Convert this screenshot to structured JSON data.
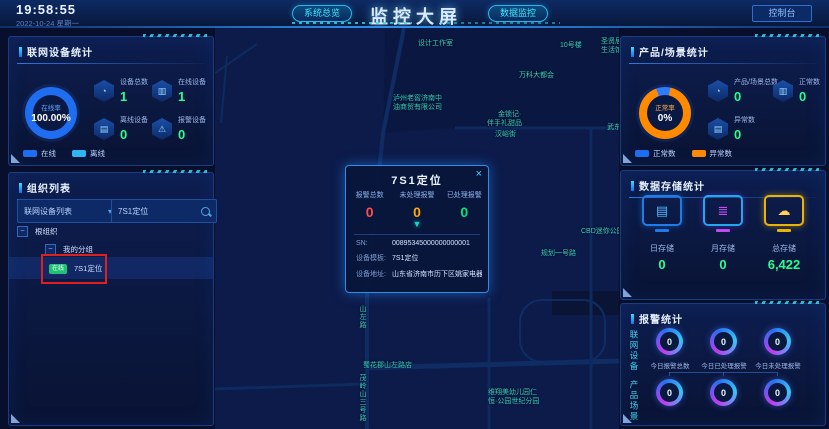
{
  "header": {
    "time": "19:58:55",
    "date": "2022-10-24 星期一",
    "tab_overview": "系统总览",
    "title": "监控大屏",
    "tab_data": "数据监控",
    "console": "控制台",
    "accent_color": "#3fe6ff"
  },
  "device_panel": {
    "title": "联网设备统计",
    "donut": {
      "label": "在线率",
      "value": "100.00%",
      "ring_color": "#1f6df0"
    },
    "stats": [
      {
        "label": "设备总数",
        "value": "1",
        "icon": "pie-icon"
      },
      {
        "label": "在线设备",
        "value": "1",
        "icon": "monitor-icon"
      },
      {
        "label": "离线设备",
        "value": "0",
        "icon": "offline-icon"
      },
      {
        "label": "报警设备",
        "value": "0",
        "icon": "alarm-icon"
      }
    ],
    "legend": [
      {
        "label": "在线",
        "color": "#1f6df0"
      },
      {
        "label": "离线",
        "color": "#2fb6f2"
      }
    ],
    "value_color": "#2aff8e"
  },
  "org_panel": {
    "title": "组织列表",
    "dropdown_value": "联网设备列表",
    "search_value": "7S1定位",
    "tree_root": "根组织",
    "tree_group": "我的分组",
    "tree_item": {
      "badge": "在线",
      "badge_color": "#21c176",
      "label": "7S1定位",
      "selected": true
    },
    "annotation_color": "#e02020"
  },
  "map": {
    "labels": [
      {
        "text": "设计工作室"
      },
      {
        "text": "10号楼"
      },
      {
        "text": "圣贤居"
      },
      {
        "text": "生活馆"
      },
      {
        "text": "万科大都会"
      },
      {
        "text": "泸州老窖济南中"
      },
      {
        "text": "油商贸有限公司"
      },
      {
        "text": "金锁记·"
      },
      {
        "text": "伴手礼甜品"
      },
      {
        "text": "汉峪街"
      },
      {
        "text": "武东"
      },
      {
        "text": "CBD迷你公园"
      },
      {
        "text": "规划一号路"
      },
      {
        "text": "山左路"
      },
      {
        "text": "蜀花郡山左路店"
      },
      {
        "text": "茂岭山三号路"
      },
      {
        "text": "维翔美幼儿园仁"
      },
      {
        "text": "恒·公园世纪分园"
      }
    ],
    "popup": {
      "title": "7S1定位",
      "close": "×",
      "marker": "▼",
      "stats": [
        {
          "label": "报警总数",
          "value": "0",
          "color": "#ff4d4d"
        },
        {
          "label": "未处理报警",
          "value": "0",
          "color": "#ffaa00"
        },
        {
          "label": "已处理报警",
          "value": "0",
          "color": "#00e67a"
        }
      ],
      "fields": [
        {
          "label": "SN:",
          "value": "00895345000000000001"
        },
        {
          "label": "设备模板:",
          "value": "7S1定位"
        },
        {
          "label": "设备地址:",
          "value": "山东省济南市历下区姚家电器规划一—…"
        }
      ]
    }
  },
  "product_panel": {
    "title": "产品/场景统计",
    "donut": {
      "label": "正常率",
      "value": "0%",
      "normal_color": "#2f7bff",
      "abnormal_color": "#ff8a00"
    },
    "stats": [
      {
        "label": "产品/场景总数",
        "value": "0",
        "icon": "pie-icon"
      },
      {
        "label": "正常数",
        "value": "0",
        "icon": "monitor-icon"
      },
      {
        "label": "异常数",
        "value": "0",
        "icon": "abnormal-icon"
      }
    ],
    "legend": [
      {
        "label": "正常数",
        "color": "#2f7bff"
      },
      {
        "label": "异常数",
        "color": "#ff8a00"
      }
    ],
    "value_color": "#2aff8e"
  },
  "storage_panel": {
    "title": "数据存储统计",
    "items": [
      {
        "label": "日存储",
        "value": "0",
        "color": "#1e7ce8",
        "icon": "document-icon"
      },
      {
        "label": "月存储",
        "value": "0",
        "color": "#c44bf5",
        "icon": "database-icon"
      },
      {
        "label": "总存储",
        "value": "6,422",
        "color": "#eab308",
        "icon": "cloud-upload-icon"
      }
    ],
    "value_color": "#2aff8e"
  },
  "alarm_panel": {
    "title": "报警统计",
    "groups": [
      "联网设备",
      "产品场景"
    ],
    "labels": [
      "今日报警总数",
      "今日已处理报警",
      "今日未处理报警"
    ],
    "row1": [
      "0",
      "0",
      "0"
    ],
    "row2": [
      "0",
      "0",
      "0"
    ]
  }
}
